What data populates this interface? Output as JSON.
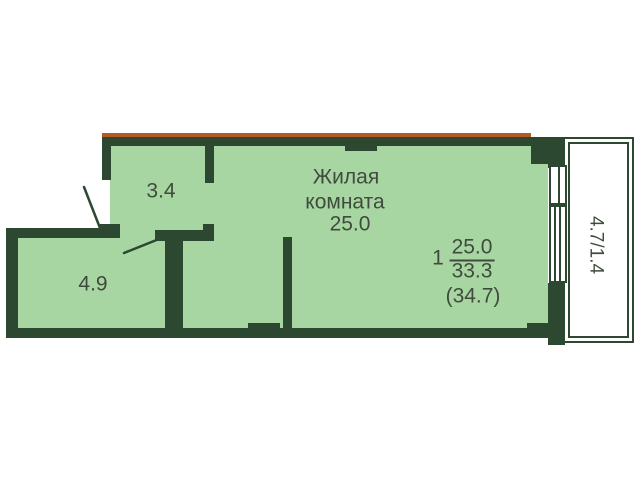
{
  "colors": {
    "wall": "#2d4830",
    "room_fill": "#a8d6a2",
    "accent_line": "#b25b24",
    "text_color": "#3f4b3c",
    "background": "#ffffff"
  },
  "rooms": {
    "living": {
      "label_line1": "Жилая",
      "label_line2": "комната",
      "area": "25.0"
    },
    "hallway": {
      "area": "3.4"
    },
    "storage": {
      "area": "4.9"
    },
    "balcony": {
      "label": "4.7/1.4"
    }
  },
  "summary": {
    "rooms_count": "1",
    "living_area": "25.0",
    "total_area": "33.3",
    "total_with_balcony": "(34.7)"
  }
}
